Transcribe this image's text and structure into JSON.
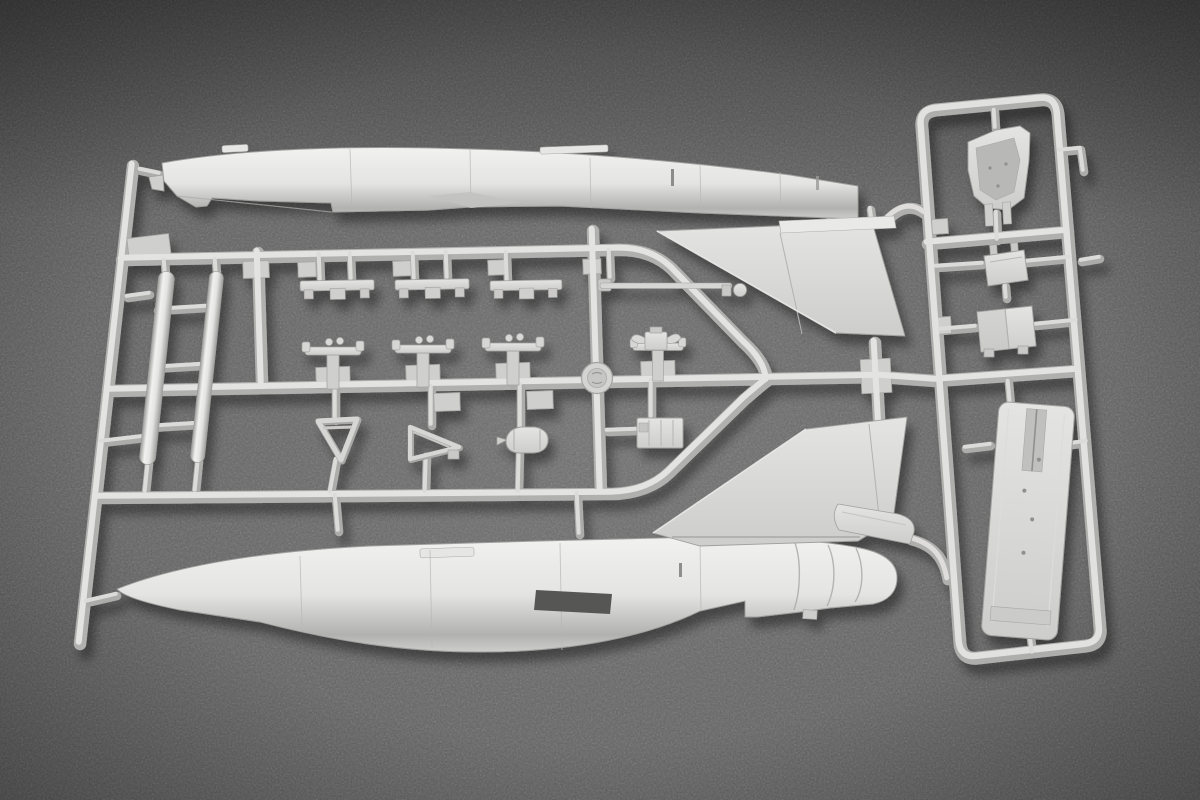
{
  "meta": {
    "type": "photograph",
    "subject": "Injection-molded light-gray plastic sprue (parts tree) of a jet-fighter scale model kit, lying on a dark speckled felt surface, letterboxed with black bars top and bottom"
  },
  "colors": {
    "letterbox_bar": "#0a0a0a",
    "felt_center": "#6b6b6b",
    "felt_edge": "#4b4b4b",
    "plastic_highlight": "#f1f1ef",
    "plastic_light": "#e4e4e2",
    "plastic_mid": "#cdcdcb",
    "plastic_shadow": "#b1b1af",
    "tank_edge": "#9d9d9b",
    "cutout_dark": "#565654",
    "shadow_color": "#000000"
  },
  "scene": {
    "main_sprue": {
      "parts": [
        {
          "name": "upper-fuselage-half"
        },
        {
          "name": "lower-fuselage-half"
        },
        {
          "name": "vertical-stabilizer-upper"
        },
        {
          "name": "vertical-stabilizer-lower"
        },
        {
          "name": "tailplane-blade"
        },
        {
          "name": "drop-tank-half-1"
        },
        {
          "name": "drop-tank-half-2"
        },
        {
          "name": "pylon-part-1"
        },
        {
          "name": "pylon-part-2"
        },
        {
          "name": "pylon-part-3"
        },
        {
          "name": "pitot-rod-part"
        },
        {
          "name": "seat-stand-part-1"
        },
        {
          "name": "seat-stand-part-2"
        },
        {
          "name": "seat-stand-part-3"
        },
        {
          "name": "seat-stand-part-4"
        },
        {
          "name": "gear-v-brace"
        },
        {
          "name": "gear-door-triangle"
        },
        {
          "name": "wheel-hub"
        },
        {
          "name": "ribbed-box-part"
        },
        {
          "name": "mold-logo-boss"
        }
      ]
    },
    "secondary_sprue": {
      "parts": [
        {
          "name": "cockpit-tub"
        },
        {
          "name": "instrument-box-small"
        },
        {
          "name": "instrument-box-large"
        },
        {
          "name": "intake-trunk-long-part"
        }
      ]
    }
  }
}
